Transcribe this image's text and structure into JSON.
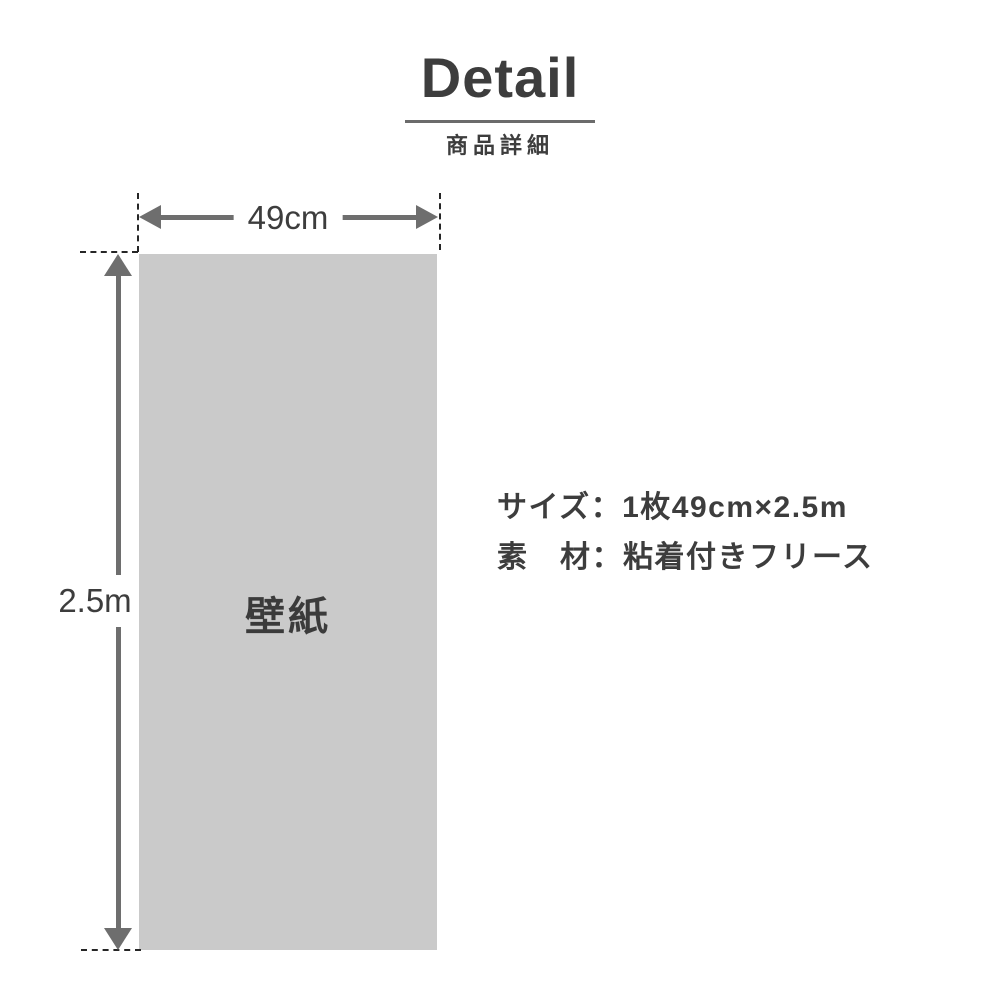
{
  "header": {
    "title": "Detail",
    "subtitle": "商品詳細"
  },
  "diagram": {
    "sheet_label": "壁紙",
    "width_label": "49cm",
    "height_label": "2.5m"
  },
  "specs": {
    "size_line": "サイズ：1枚49cm×2.5m",
    "material_line": "素　材：粘着付きフリース"
  },
  "colors": {
    "background": "#ffffff",
    "text_dark": "#3d3d3d",
    "arrow_gray": "#6e6e6e",
    "sheet_fill": "#cacaca",
    "dash_color": "#262626",
    "underline_gray": "#6b6b6b"
  }
}
